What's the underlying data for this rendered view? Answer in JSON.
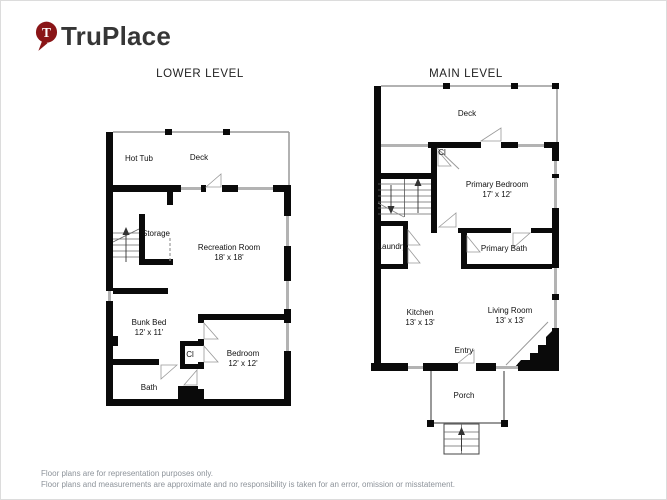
{
  "logo": {
    "brand": "TruPlace",
    "pin_letter": "T"
  },
  "lower_level": {
    "title": "LOWER LEVEL",
    "rooms": {
      "hot_tub": {
        "name": "Hot Tub"
      },
      "deck": {
        "name": "Deck"
      },
      "storage": {
        "name": "Storage"
      },
      "recreation_room": {
        "name": "Recreation Room",
        "dims": "18' x 18'"
      },
      "bunk_bed": {
        "name": "Bunk Bed",
        "dims": "12' x 11'"
      },
      "closet": {
        "name": "Cl"
      },
      "bedroom": {
        "name": "Bedroom",
        "dims": "12' x 12'"
      },
      "bath": {
        "name": "Bath"
      }
    }
  },
  "main_level": {
    "title": "MAIN LEVEL",
    "rooms": {
      "deck": {
        "name": "Deck"
      },
      "closet": {
        "name": "Cl"
      },
      "primary_bedroom": {
        "name": "Primary Bedroom",
        "dims": "17' x 12'"
      },
      "laundry": {
        "name": "Laundry"
      },
      "primary_bath": {
        "name": "Primary Bath"
      },
      "kitchen": {
        "name": "Kitchen",
        "dims": "13' x 13'"
      },
      "living_room": {
        "name": "Living Room",
        "dims": "13' x 13'"
      },
      "entry": {
        "name": "Entry"
      },
      "porch": {
        "name": "Porch"
      }
    }
  },
  "footer": {
    "line1": "Floor plans are for representation purposes only.",
    "line2": "Floor plans and measurements are approximate and no responsibility is taken for an error, omission or misstatement."
  },
  "colors": {
    "brand_red": "#8A1517",
    "wall_black": "#0A0A0A",
    "window_gray": "#B3B3B3",
    "footer_text_gray": "#8D939A"
  }
}
